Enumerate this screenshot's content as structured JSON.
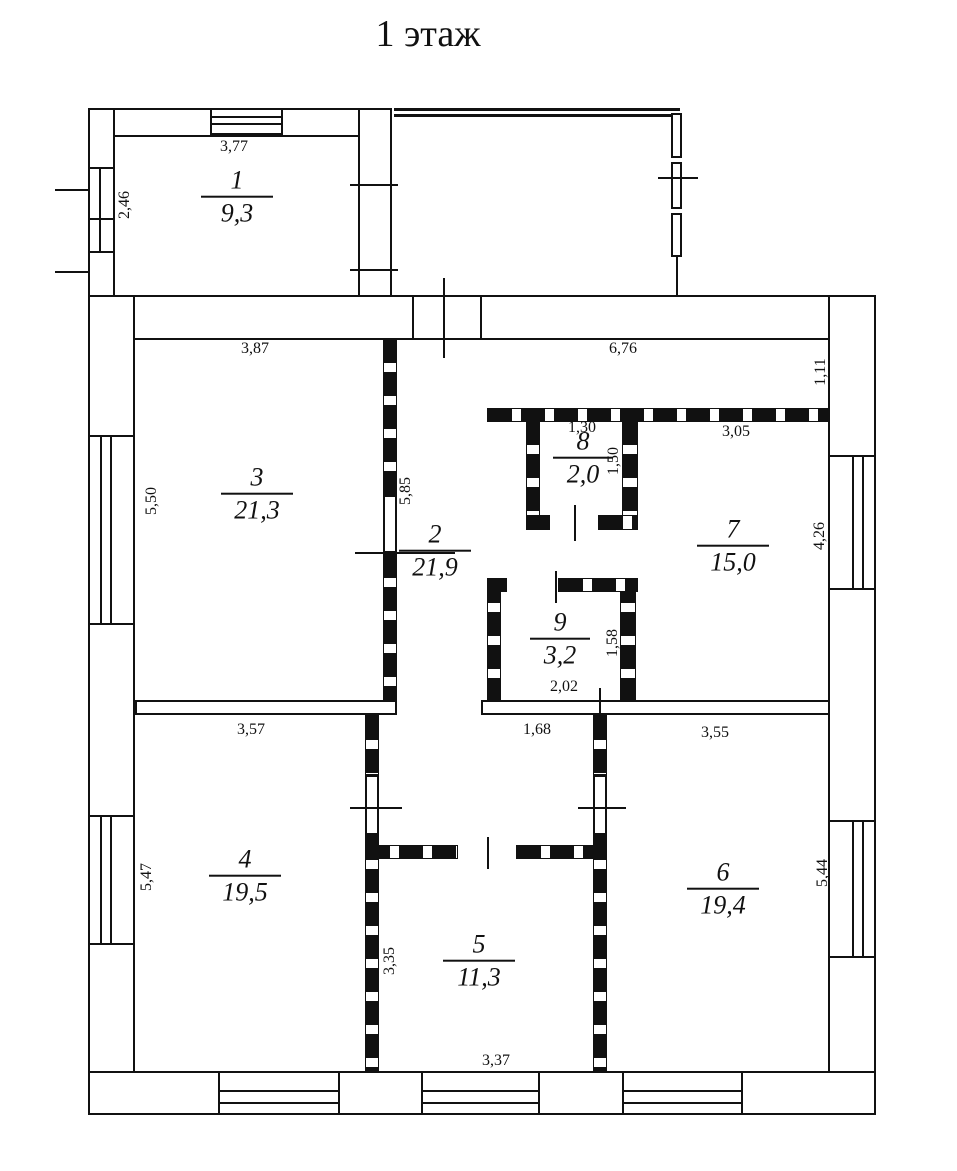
{
  "title": "1 этаж",
  "rooms": [
    {
      "number": "1",
      "area": "9,3"
    },
    {
      "number": "2",
      "area": "21,9"
    },
    {
      "number": "3",
      "area": "21,3"
    },
    {
      "number": "4",
      "area": "19,5"
    },
    {
      "number": "5",
      "area": "11,3"
    },
    {
      "number": "6",
      "area": "19,4"
    },
    {
      "number": "7",
      "area": "15,0"
    },
    {
      "number": "8",
      "area": "2,0"
    },
    {
      "number": "9",
      "area": "3,2"
    }
  ],
  "dimensions": {
    "room1_width": "3,77",
    "room1_height": "2,46",
    "room3_width": "3,87",
    "room3_height": "5,50",
    "hall_height": "5,85",
    "hall_top_width": "6,76",
    "hall_top_height": "1,11",
    "room7_width": "3,05",
    "room7_height": "4,26",
    "room8_width": "1,30",
    "room8_height": "1,50",
    "room9_width": "2,02",
    "room9_height": "1,58",
    "room4_width": "3,57",
    "room4_height": "5,47",
    "corridor_opening": "1,68",
    "room6_width": "3,55",
    "room6_height": "5,44",
    "room5_height": "3,35",
    "room5_width": "3,37"
  },
  "colors": {
    "line": "#111111",
    "background": "#ffffff"
  }
}
